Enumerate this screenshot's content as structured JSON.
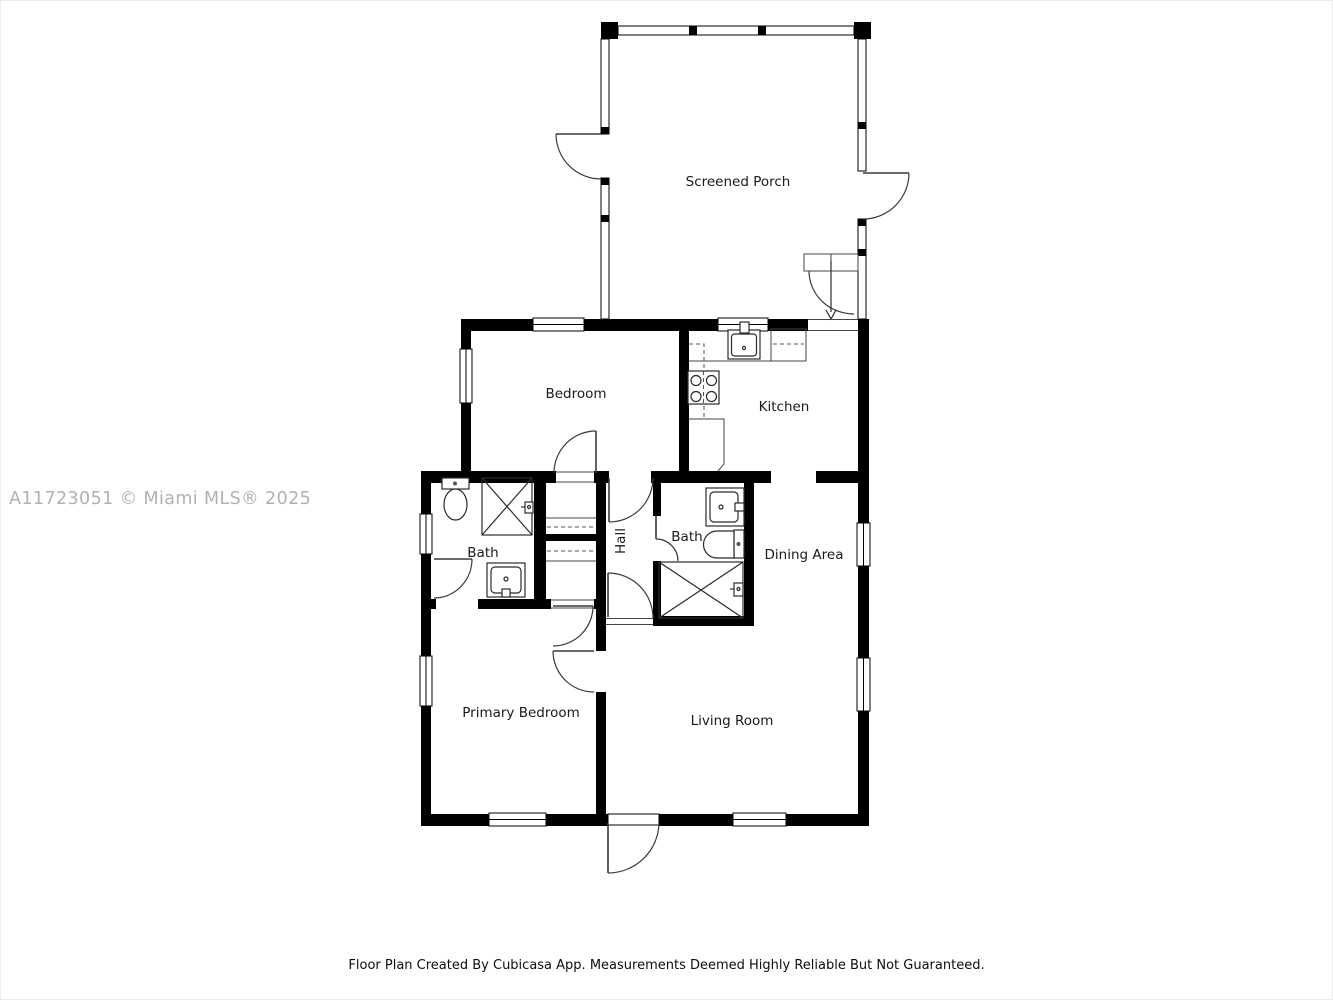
{
  "watermark": "A11723051 © Miami MLS® 2025",
  "footer_note": "Floor Plan Created By Cubicasa App. Measurements Deemed Highly Reliable But Not Guaranteed.",
  "rooms": [
    {
      "label": "Screened Porch"
    },
    {
      "label": "Bedroom"
    },
    {
      "label": "Kitchen"
    },
    {
      "label": "Bath"
    },
    {
      "label": "Hall"
    },
    {
      "label": "Bath"
    },
    {
      "label": "Dining Area"
    },
    {
      "label": "Primary Bedroom"
    },
    {
      "label": "Living Room"
    }
  ],
  "fixtures": [
    "stove-icon",
    "kitchen-sink-icon",
    "fridge-icon",
    "toilet-icon",
    "shower-icon",
    "vanity-sink-icon",
    "bathtub-icon",
    "stairs-icon",
    "door-swing-icon",
    "window-icon"
  ],
  "colors": {
    "wall": "#000000",
    "room_floor": "#ffffff",
    "label_text": "#1a1a1a",
    "fixture_line": "#2b2b2b",
    "watermark": "#b1b1b4",
    "footer_text": "#0d0d0d"
  }
}
